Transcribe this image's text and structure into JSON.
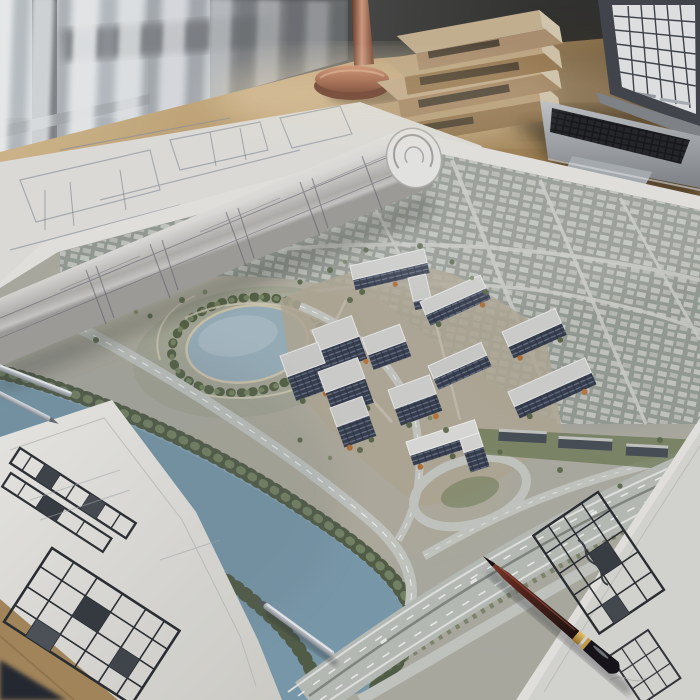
{
  "scene": {
    "description": "Photorealistic architect's desk: large aerial urban-development site plan spread on a wooden desk, rolled blueprint, hand-drawn floor-plan sketch sheets, pencil, drafting pens, laptop showing a floor plan, stacked books and a copper lamp base by a curtained window",
    "objects": [
      "window",
      "sheer-curtains",
      "wooden-desk",
      "copper-lamp-base",
      "book-stack",
      "laptop",
      "rolled-blueprint",
      "flat-blueprint-sheet",
      "site-plan-map",
      "pond",
      "river",
      "highway",
      "apartment-buildings",
      "city-district",
      "sketch-sheet-bottom-left",
      "sketch-sheet-bottom-right",
      "maroon-pencil",
      "silver-drafting-pen",
      "metal-ruler-tools"
    ],
    "counts": {
      "books": 4,
      "apartment_buildings": 12,
      "sketch_sheets": 2
    }
  },
  "palette": {
    "wall_dark": "#35342f",
    "window_glass": "#ccd2d7",
    "curtain": "#e9ebed",
    "desk_wood": "#bd9c6e",
    "desk_edge_wood": "#ab8c5e",
    "corner_shadow": "#262b33",
    "copper": "#b5755c",
    "book_cover": "#c6ae88",
    "laptop_body": "#9ea3a8",
    "laptop_screen": "#e9ebec",
    "paper": "#edece7",
    "paper_shaded": "#deddd8",
    "map_ground": "#b2b1a5",
    "city_fabric": "#9aa098",
    "pond_water": "#9db4be",
    "river_water": "#7e9fb0",
    "trees_dark": "#55614a",
    "trees_light": "#7a8868",
    "road_light": "#c9ccc6",
    "highway": "#bfc3bd",
    "roof_light": "#d6d7d3",
    "facade_dark": "#394050",
    "autumn_trees": "#b5743c",
    "pencil_body": "#5a2420",
    "gold_band": "#c9a24a",
    "metal": "#c6cbd0"
  }
}
